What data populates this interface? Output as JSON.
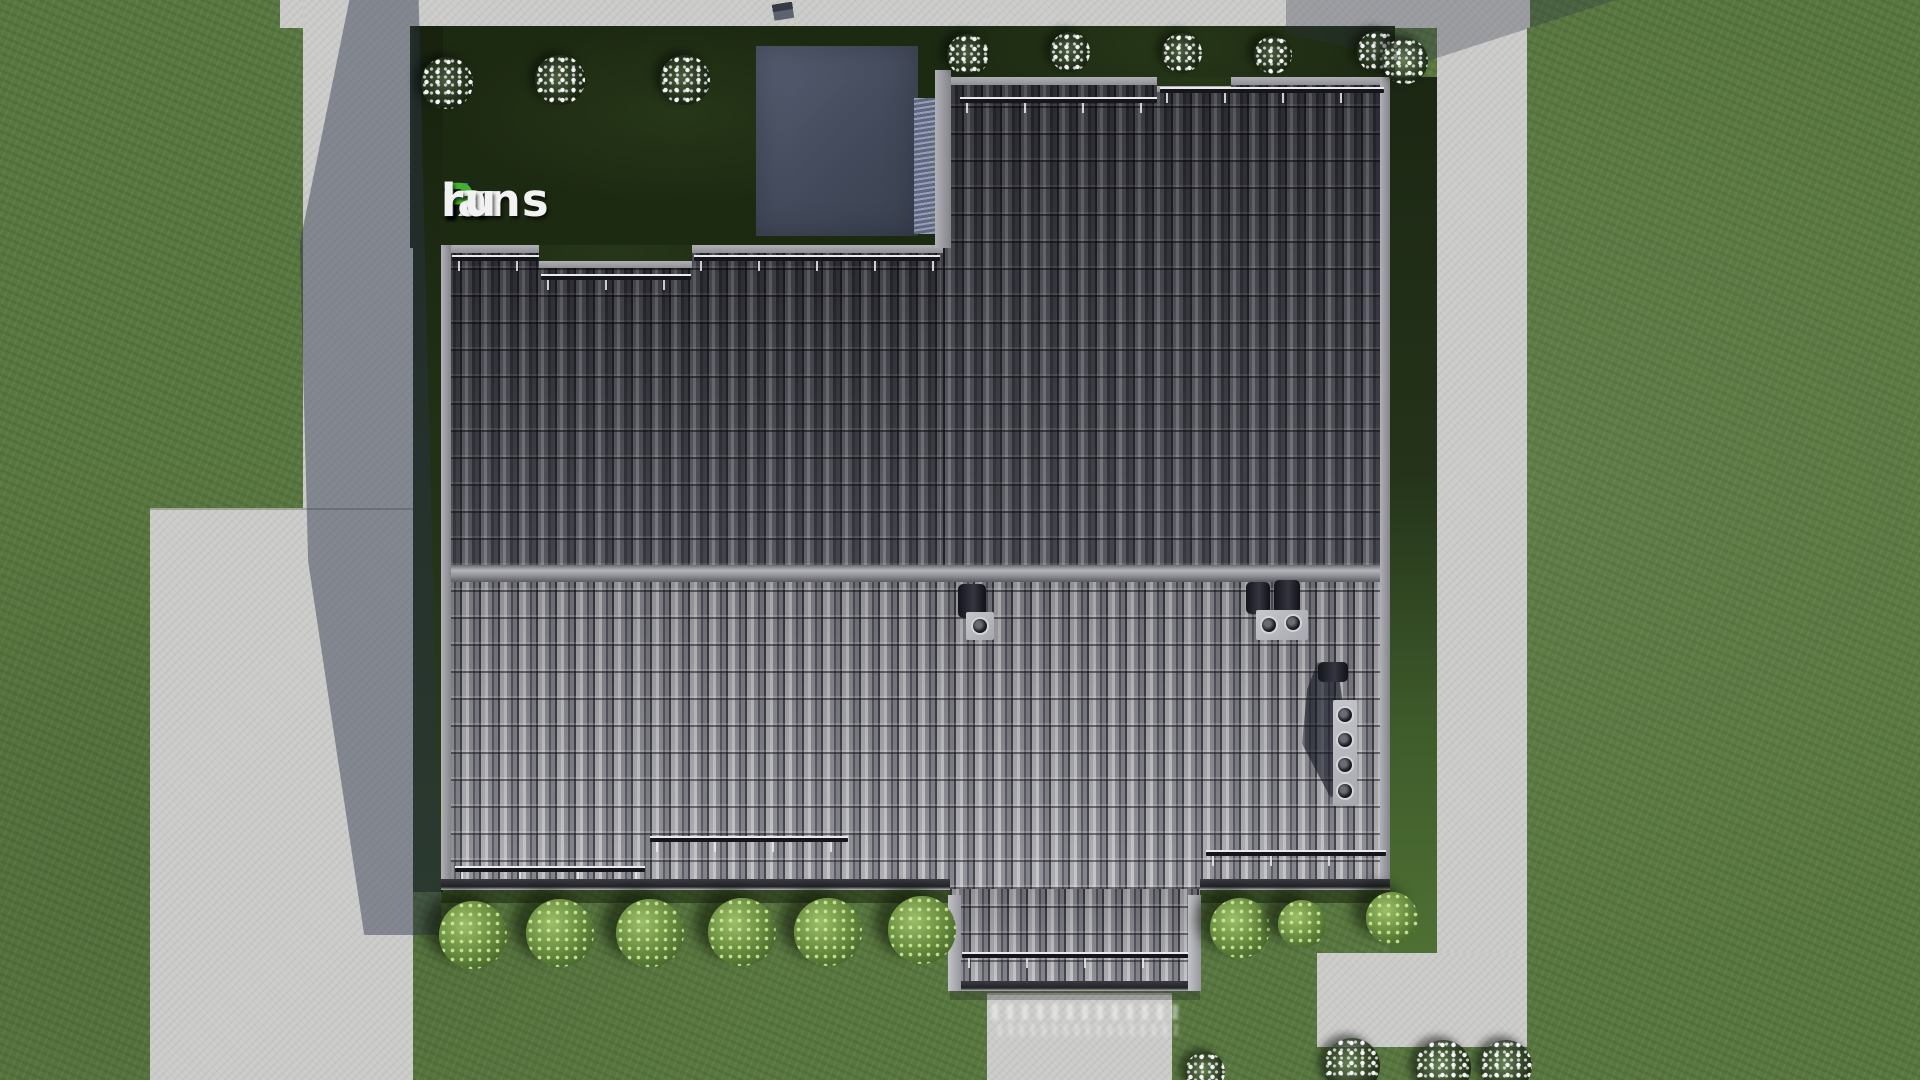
{
  "watermark": {
    "full_text": "FixPlans.ru",
    "parts": [
      {
        "text": "F",
        "color": "#2e6fd8"
      },
      {
        "text": "ix",
        "color": "#f2f2f2"
      },
      {
        "text": "P",
        "color": "#44b02c"
      },
      {
        "text": "lans",
        "color": "#f2f2f2"
      },
      {
        "text": ".",
        "color": "#2e6fd8"
      },
      {
        "text": "ru",
        "color": "#f2f2f2"
      }
    ]
  },
  "scene": {
    "type": "3d architectural render, top-down site plan",
    "subject": "single-family house roof with dark barrel tiles, lawn and concrete walkways",
    "colors": {
      "lawn_sunlit": "#597740",
      "lawn_shadow": "#1d2a12",
      "concrete_path": "#cbcbc9",
      "roof_north_slope": "#45454c",
      "roof_south_slope": "#8f8f95",
      "ridge": "#97979d",
      "roof_trim": "#95969c",
      "cast_shadow": "#2a3346",
      "logo_blue": "#2e6fd8",
      "logo_green": "#44b02c",
      "logo_white": "#f2f2f2"
    },
    "features": {
      "roof_vents": 3,
      "snow_guard_rails": 9,
      "green_bushes": 9,
      "white_flower_bushes": 13,
      "porch_posts": 2
    }
  }
}
